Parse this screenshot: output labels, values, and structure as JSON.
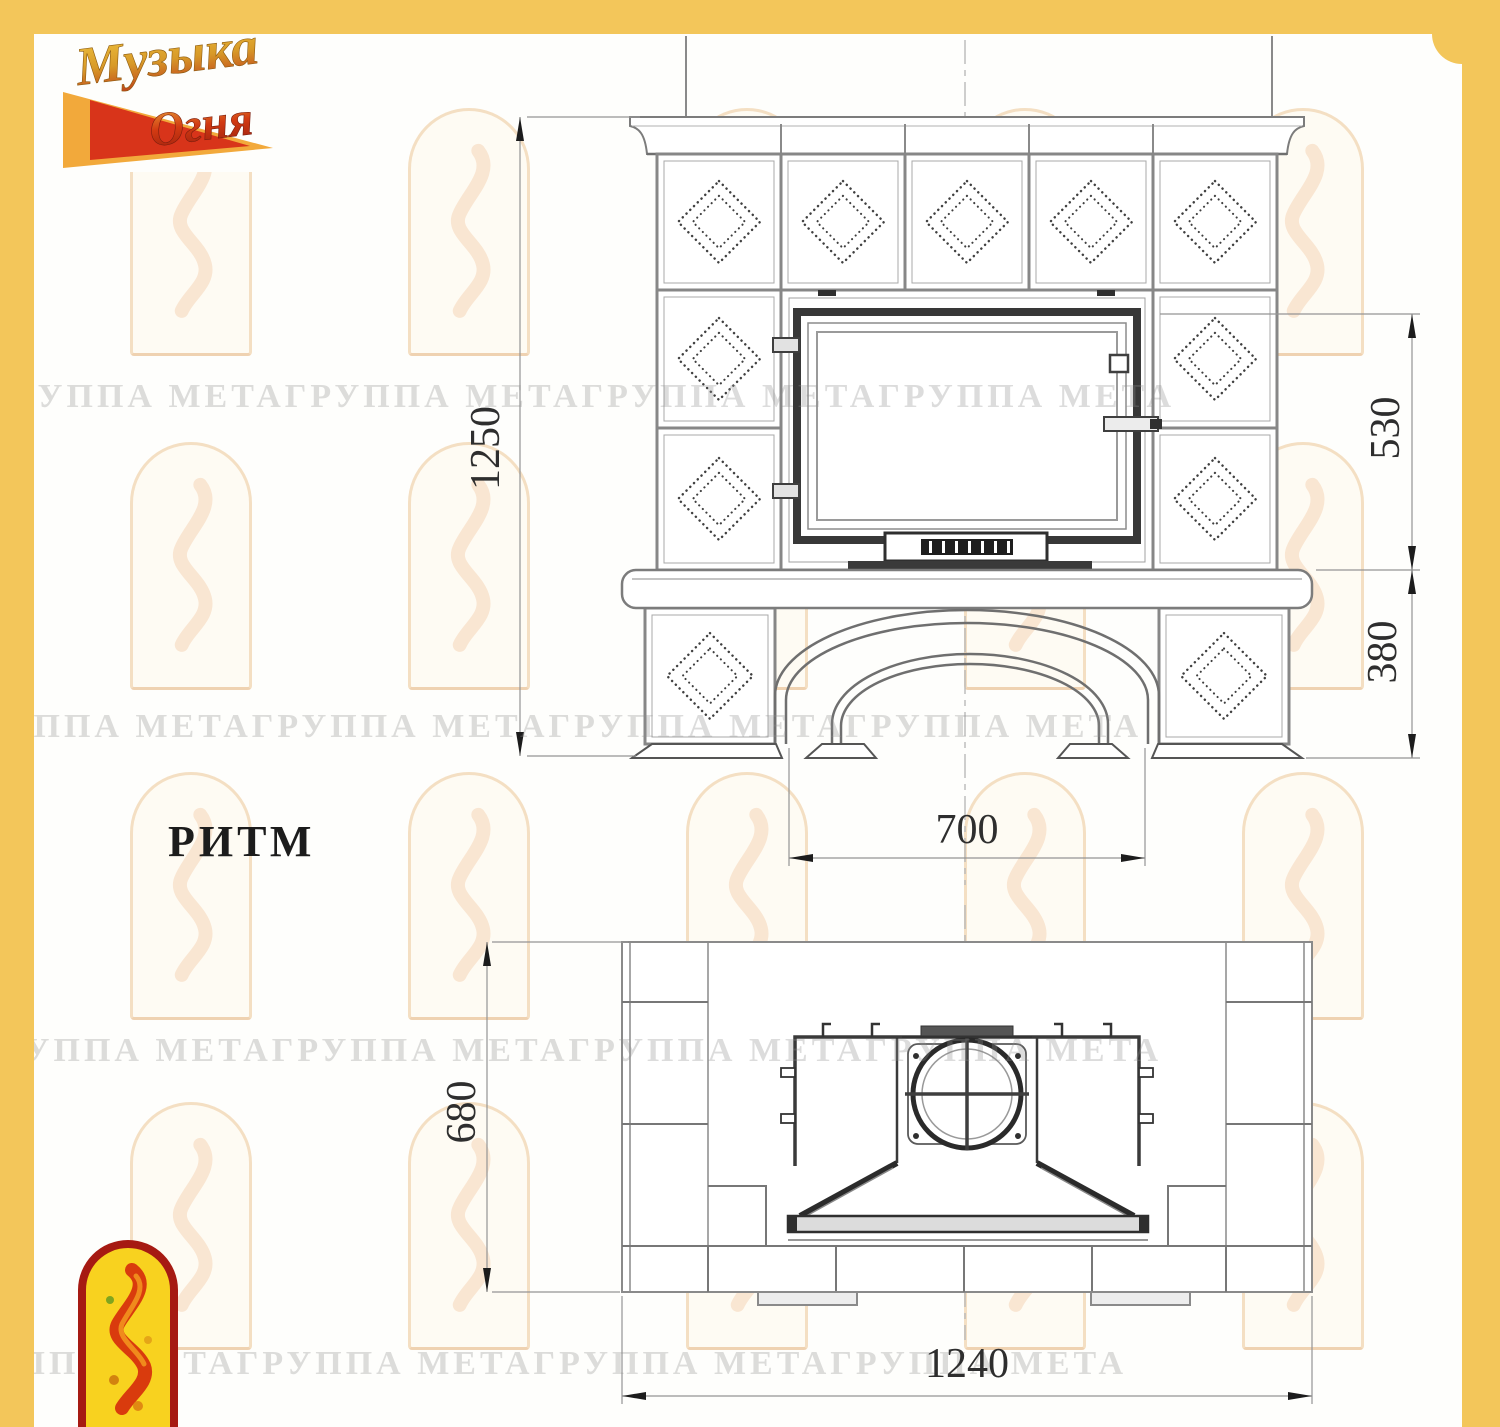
{
  "brand": {
    "word1": "Музыка",
    "word2": "Огня"
  },
  "watermark_text": "ГРУППА МЕТАГРУППА МЕТАГРУППА МЕТАГРУППА МЕТА",
  "model_label": "РИТМ",
  "dimensions": {
    "front_overall_height": "1250",
    "front_firebox_height": "530",
    "front_base_height": "380",
    "front_portal_width": "700",
    "plan_depth": "680",
    "plan_overall_width": "1240"
  },
  "colors": {
    "frame_yellow": "#F3C65A",
    "dimension_text": "#2e2e2e",
    "logo_red": "#A61A12",
    "logo_yellow": "#F8D21F"
  }
}
